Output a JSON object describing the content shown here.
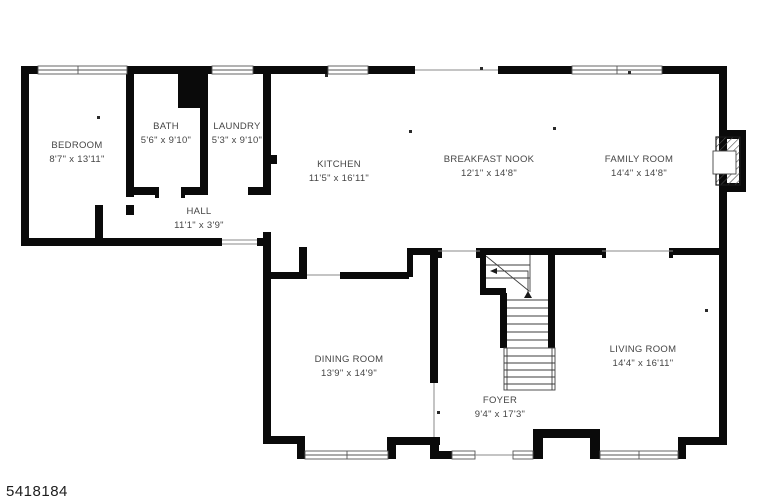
{
  "floor_plan": {
    "rooms": [
      {
        "name": "BEDROOM",
        "dims": "8'7\" x 13'11\""
      },
      {
        "name": "BATH",
        "dims": "5'6\" x 9'10\""
      },
      {
        "name": "LAUNDRY",
        "dims": "5'3\" x 9'10\""
      },
      {
        "name": "KITCHEN",
        "dims": "11'5\" x 16'11\""
      },
      {
        "name": "BREAKFAST NOOK",
        "dims": "12'1\" x 14'8\""
      },
      {
        "name": "FAMILY ROOM",
        "dims": "14'4\" x 14'8\""
      },
      {
        "name": "HALL",
        "dims": "11'1\" x 3'9\""
      },
      {
        "name": "DINING ROOM",
        "dims": "13'9\" x 14'9\""
      },
      {
        "name": "FOYER",
        "dims": "9'4\" x 17'3\""
      },
      {
        "name": "LIVING ROOM",
        "dims": "14'4\" x 16'11\""
      }
    ],
    "watermark": "5418184",
    "colors": {
      "wall": "#0a0a0a",
      "background": "#ffffff",
      "label": "#454545",
      "opening_line": "#8a8a8a"
    }
  }
}
